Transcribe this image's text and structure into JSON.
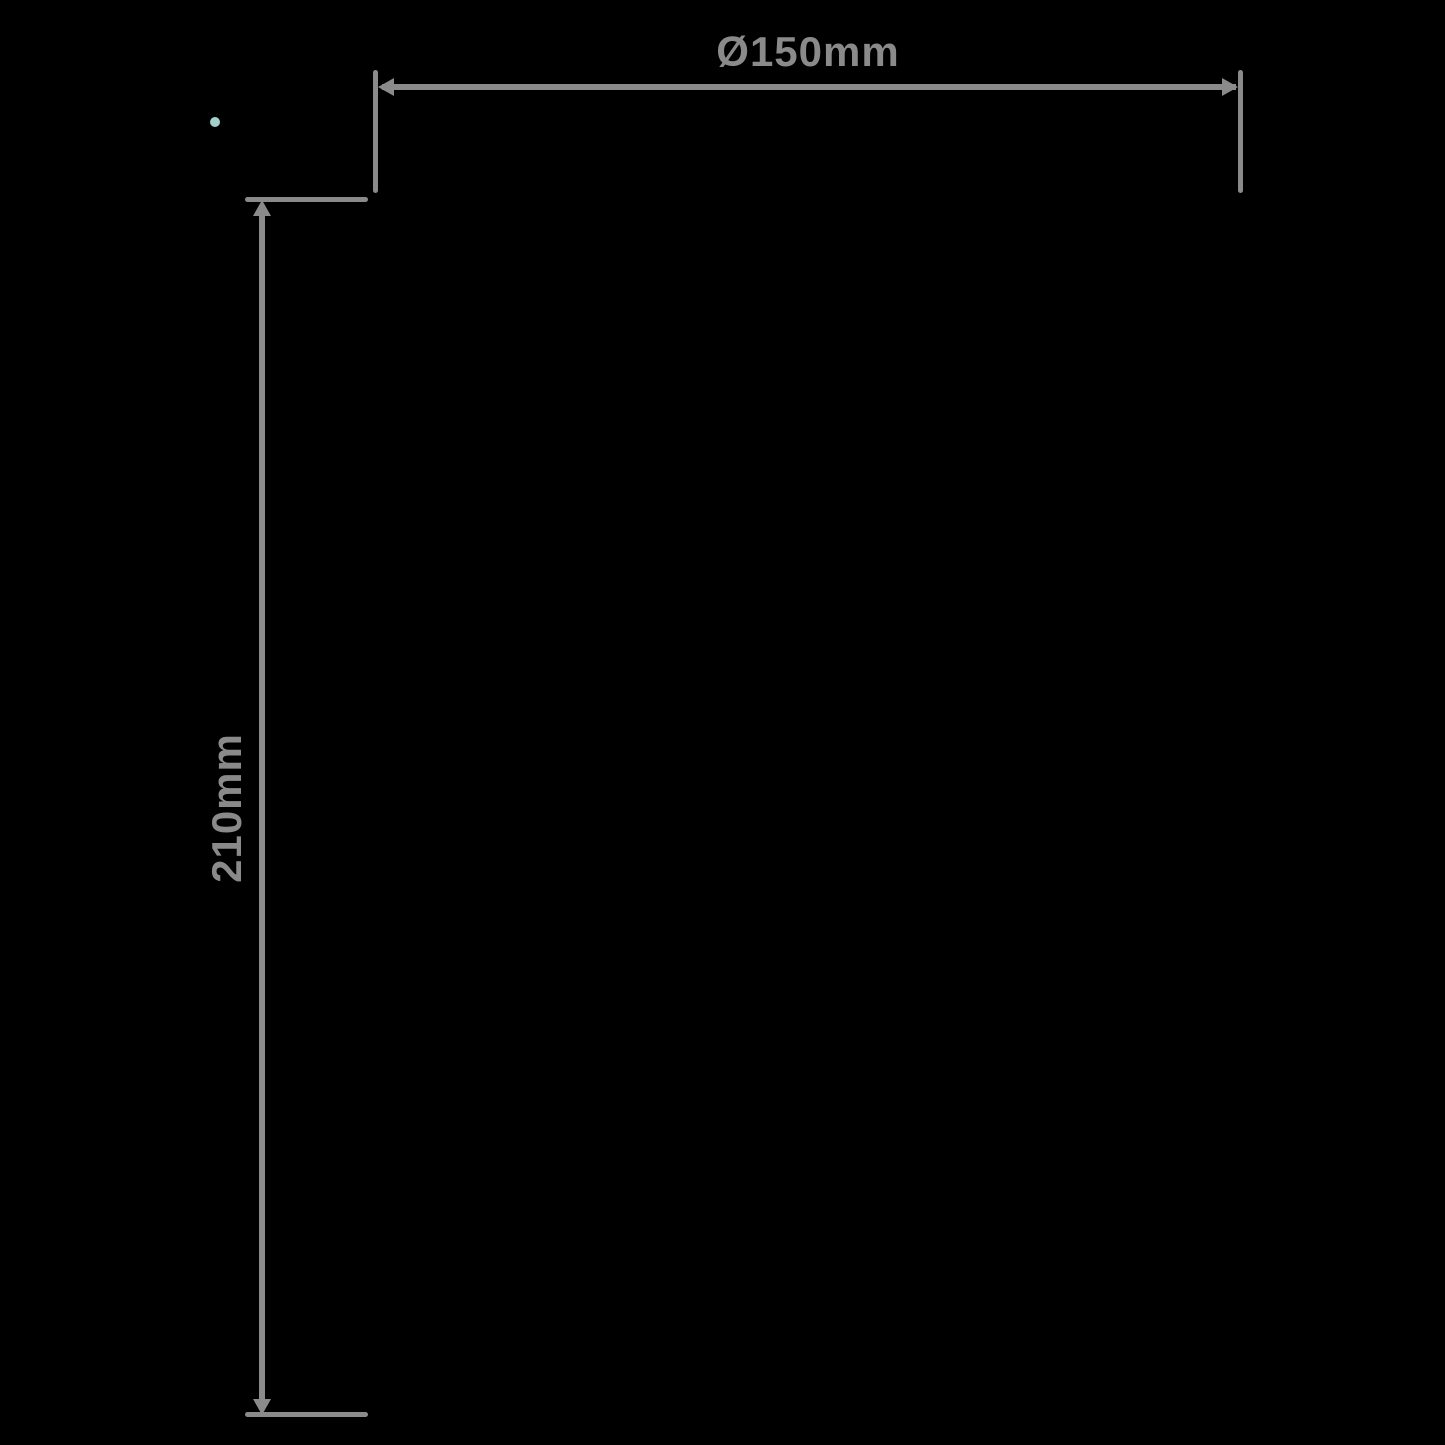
{
  "diagram": {
    "type": "product-dimension-drawing",
    "background_color": "#000000",
    "line_color": "#8a8a8a",
    "accent_dot_color": "#a2d1cd",
    "diameter_label": "Ø150mm",
    "height_label": "210mm"
  }
}
